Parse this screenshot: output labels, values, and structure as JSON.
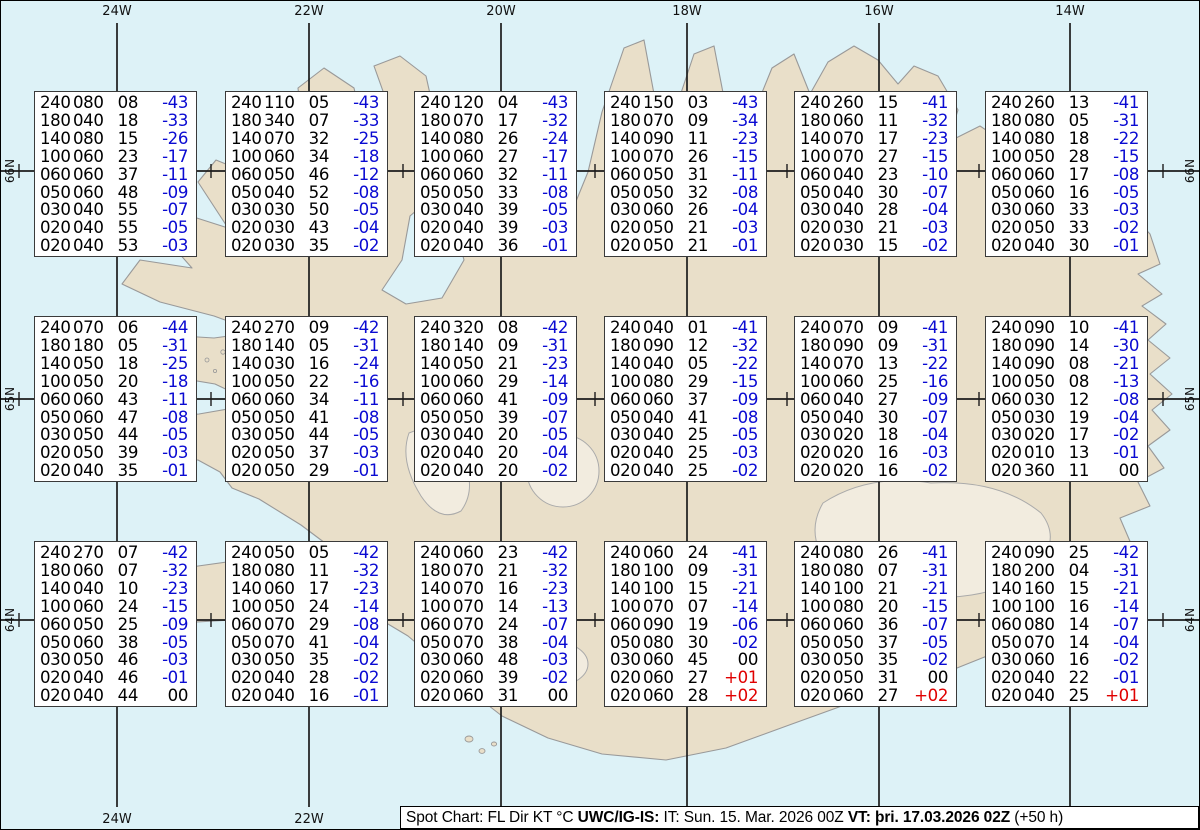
{
  "colors": {
    "ocean": "#ddf2f7",
    "land": "#e9dfc9",
    "coastline": "#999999",
    "gridline": "#1c1c1c",
    "temp_negative": "#0a0ad2",
    "temp_positive": "#e00000",
    "text": "#000000"
  },
  "grid": {
    "longitudes": [
      {
        "label": "24W",
        "x": 116
      },
      {
        "label": "22W",
        "x": 308
      },
      {
        "label": "20W",
        "x": 500
      },
      {
        "label": "18W",
        "x": 686
      },
      {
        "label": "16W",
        "x": 878
      },
      {
        "label": "14W",
        "x": 1069
      }
    ],
    "latitudes": [
      {
        "label": "66N",
        "y": 170
      },
      {
        "label": "65N",
        "y": 398
      },
      {
        "label": "64N",
        "y": 619
      }
    ],
    "minor_tick_xs": [
      18,
      210,
      402,
      594,
      786,
      978,
      1162
    ]
  },
  "caption": {
    "segments": [
      {
        "text": "Spot Chart: FL Dir KT °C ",
        "bold": false
      },
      {
        "text": "UWC/IG-IS:",
        "bold": true
      },
      {
        "text": " IT: Sun. 15. Mar. 2026 00Z ",
        "bold": false
      },
      {
        "text": "VT: þri. 17.03.2026 02Z",
        "bold": true
      },
      {
        "text": " (+50 h)",
        "bold": false
      }
    ]
  },
  "spot_box_columns": [
    "FL",
    "Dir",
    "KT",
    "°C"
  ],
  "spot_boxes": [
    {
      "x": 33,
      "y": 90,
      "levels": [
        [
          "240",
          "080",
          "08",
          "-43"
        ],
        [
          "180",
          "040",
          "18",
          "-33"
        ],
        [
          "140",
          "080",
          "15",
          "-26"
        ],
        [
          "100",
          "060",
          "23",
          "-17"
        ],
        [
          "060",
          "060",
          "37",
          "-11"
        ],
        [
          "050",
          "060",
          "48",
          "-09"
        ],
        [
          "030",
          "040",
          "55",
          "-07"
        ],
        [
          "020",
          "040",
          "55",
          "-05"
        ],
        [
          "020",
          "040",
          "53",
          "-03"
        ]
      ]
    },
    {
      "x": 224,
      "y": 90,
      "levels": [
        [
          "240",
          "110",
          "05",
          "-43"
        ],
        [
          "180",
          "340",
          "07",
          "-33"
        ],
        [
          "140",
          "070",
          "32",
          "-25"
        ],
        [
          "100",
          "060",
          "34",
          "-18"
        ],
        [
          "060",
          "050",
          "46",
          "-12"
        ],
        [
          "050",
          "040",
          "52",
          "-08"
        ],
        [
          "030",
          "030",
          "50",
          "-05"
        ],
        [
          "020",
          "030",
          "43",
          "-04"
        ],
        [
          "020",
          "030",
          "35",
          "-02"
        ]
      ]
    },
    {
      "x": 413,
      "y": 90,
      "levels": [
        [
          "240",
          "120",
          "04",
          "-43"
        ],
        [
          "180",
          "070",
          "17",
          "-32"
        ],
        [
          "140",
          "080",
          "26",
          "-24"
        ],
        [
          "100",
          "060",
          "27",
          "-17"
        ],
        [
          "060",
          "060",
          "32",
          "-11"
        ],
        [
          "050",
          "050",
          "33",
          "-08"
        ],
        [
          "030",
          "040",
          "39",
          "-05"
        ],
        [
          "020",
          "040",
          "39",
          "-03"
        ],
        [
          "020",
          "040",
          "36",
          "-01"
        ]
      ]
    },
    {
      "x": 603,
      "y": 90,
      "levels": [
        [
          "240",
          "150",
          "03",
          "-43"
        ],
        [
          "180",
          "070",
          "09",
          "-34"
        ],
        [
          "140",
          "090",
          "11",
          "-23"
        ],
        [
          "100",
          "070",
          "26",
          "-15"
        ],
        [
          "060",
          "050",
          "31",
          "-11"
        ],
        [
          "050",
          "050",
          "32",
          "-08"
        ],
        [
          "030",
          "060",
          "26",
          "-04"
        ],
        [
          "020",
          "050",
          "21",
          "-03"
        ],
        [
          "020",
          "050",
          "21",
          "-01"
        ]
      ]
    },
    {
      "x": 793,
      "y": 90,
      "levels": [
        [
          "240",
          "260",
          "15",
          "-41"
        ],
        [
          "180",
          "060",
          "11",
          "-32"
        ],
        [
          "140",
          "070",
          "17",
          "-23"
        ],
        [
          "100",
          "070",
          "27",
          "-15"
        ],
        [
          "060",
          "040",
          "23",
          "-10"
        ],
        [
          "050",
          "040",
          "30",
          "-07"
        ],
        [
          "030",
          "040",
          "28",
          "-04"
        ],
        [
          "020",
          "030",
          "21",
          "-03"
        ],
        [
          "020",
          "030",
          "15",
          "-02"
        ]
      ]
    },
    {
      "x": 984,
      "y": 90,
      "levels": [
        [
          "240",
          "260",
          "13",
          "-41"
        ],
        [
          "180",
          "080",
          "05",
          "-31"
        ],
        [
          "140",
          "080",
          "18",
          "-22"
        ],
        [
          "100",
          "050",
          "28",
          "-15"
        ],
        [
          "060",
          "060",
          "17",
          "-08"
        ],
        [
          "050",
          "060",
          "16",
          "-05"
        ],
        [
          "030",
          "060",
          "33",
          "-03"
        ],
        [
          "020",
          "050",
          "33",
          "-02"
        ],
        [
          "020",
          "040",
          "30",
          "-01"
        ]
      ]
    },
    {
      "x": 33,
      "y": 315,
      "levels": [
        [
          "240",
          "070",
          "06",
          "-44"
        ],
        [
          "180",
          "180",
          "05",
          "-31"
        ],
        [
          "140",
          "050",
          "18",
          "-25"
        ],
        [
          "100",
          "050",
          "20",
          "-18"
        ],
        [
          "060",
          "060",
          "43",
          "-11"
        ],
        [
          "050",
          "060",
          "47",
          "-08"
        ],
        [
          "030",
          "050",
          "44",
          "-05"
        ],
        [
          "020",
          "050",
          "39",
          "-03"
        ],
        [
          "020",
          "040",
          "35",
          "-01"
        ]
      ]
    },
    {
      "x": 224,
      "y": 315,
      "levels": [
        [
          "240",
          "270",
          "09",
          "-42"
        ],
        [
          "180",
          "140",
          "05",
          "-31"
        ],
        [
          "140",
          "030",
          "16",
          "-24"
        ],
        [
          "100",
          "050",
          "22",
          "-16"
        ],
        [
          "060",
          "060",
          "34",
          "-11"
        ],
        [
          "050",
          "050",
          "41",
          "-08"
        ],
        [
          "030",
          "050",
          "44",
          "-05"
        ],
        [
          "020",
          "050",
          "37",
          "-03"
        ],
        [
          "020",
          "050",
          "29",
          "-01"
        ]
      ]
    },
    {
      "x": 413,
      "y": 315,
      "levels": [
        [
          "240",
          "320",
          "08",
          "-42"
        ],
        [
          "180",
          "140",
          "09",
          "-31"
        ],
        [
          "140",
          "050",
          "21",
          "-23"
        ],
        [
          "100",
          "060",
          "29",
          "-14"
        ],
        [
          "060",
          "060",
          "41",
          "-09"
        ],
        [
          "050",
          "050",
          "39",
          "-07"
        ],
        [
          "030",
          "040",
          "20",
          "-05"
        ],
        [
          "020",
          "040",
          "20",
          "-04"
        ],
        [
          "020",
          "040",
          "20",
          "-02"
        ]
      ]
    },
    {
      "x": 603,
      "y": 315,
      "levels": [
        [
          "240",
          "040",
          "01",
          "-41"
        ],
        [
          "180",
          "090",
          "12",
          "-32"
        ],
        [
          "140",
          "040",
          "05",
          "-22"
        ],
        [
          "100",
          "080",
          "29",
          "-15"
        ],
        [
          "060",
          "060",
          "37",
          "-09"
        ],
        [
          "050",
          "040",
          "41",
          "-08"
        ],
        [
          "030",
          "040",
          "25",
          "-05"
        ],
        [
          "020",
          "040",
          "25",
          "-03"
        ],
        [
          "020",
          "040",
          "25",
          "-02"
        ]
      ]
    },
    {
      "x": 793,
      "y": 315,
      "levels": [
        [
          "240",
          "070",
          "09",
          "-41"
        ],
        [
          "180",
          "090",
          "09",
          "-31"
        ],
        [
          "140",
          "070",
          "13",
          "-22"
        ],
        [
          "100",
          "060",
          "25",
          "-16"
        ],
        [
          "060",
          "040",
          "27",
          "-09"
        ],
        [
          "050",
          "040",
          "30",
          "-07"
        ],
        [
          "030",
          "020",
          "18",
          "-04"
        ],
        [
          "020",
          "020",
          "16",
          "-03"
        ],
        [
          "020",
          "020",
          "16",
          "-02"
        ]
      ]
    },
    {
      "x": 984,
      "y": 315,
      "levels": [
        [
          "240",
          "090",
          "10",
          "-41"
        ],
        [
          "180",
          "090",
          "14",
          "-30"
        ],
        [
          "140",
          "090",
          "08",
          "-21"
        ],
        [
          "100",
          "050",
          "08",
          "-13"
        ],
        [
          "060",
          "030",
          "12",
          "-08"
        ],
        [
          "050",
          "030",
          "19",
          "-04"
        ],
        [
          "030",
          "020",
          "17",
          "-02"
        ],
        [
          "020",
          "010",
          "13",
          "-01"
        ],
        [
          "020",
          "360",
          "11",
          "00"
        ]
      ]
    },
    {
      "x": 33,
      "y": 540,
      "levels": [
        [
          "240",
          "270",
          "07",
          "-42"
        ],
        [
          "180",
          "060",
          "07",
          "-32"
        ],
        [
          "140",
          "040",
          "10",
          "-23"
        ],
        [
          "100",
          "060",
          "24",
          "-15"
        ],
        [
          "060",
          "050",
          "25",
          "-09"
        ],
        [
          "050",
          "060",
          "38",
          "-05"
        ],
        [
          "030",
          "050",
          "46",
          "-03"
        ],
        [
          "020",
          "040",
          "46",
          "-01"
        ],
        [
          "020",
          "040",
          "44",
          "00"
        ]
      ]
    },
    {
      "x": 224,
      "y": 540,
      "levels": [
        [
          "240",
          "050",
          "05",
          "-42"
        ],
        [
          "180",
          "080",
          "11",
          "-32"
        ],
        [
          "140",
          "060",
          "17",
          "-23"
        ],
        [
          "100",
          "050",
          "24",
          "-14"
        ],
        [
          "060",
          "070",
          "29",
          "-08"
        ],
        [
          "050",
          "070",
          "41",
          "-04"
        ],
        [
          "030",
          "050",
          "35",
          "-02"
        ],
        [
          "020",
          "040",
          "28",
          "-02"
        ],
        [
          "020",
          "040",
          "16",
          "-01"
        ]
      ]
    },
    {
      "x": 413,
      "y": 540,
      "levels": [
        [
          "240",
          "060",
          "23",
          "-42"
        ],
        [
          "180",
          "070",
          "21",
          "-32"
        ],
        [
          "140",
          "070",
          "16",
          "-23"
        ],
        [
          "100",
          "070",
          "14",
          "-13"
        ],
        [
          "060",
          "070",
          "24",
          "-07"
        ],
        [
          "050",
          "070",
          "38",
          "-04"
        ],
        [
          "030",
          "060",
          "48",
          "-03"
        ],
        [
          "020",
          "060",
          "39",
          "-02"
        ],
        [
          "020",
          "060",
          "31",
          "00"
        ]
      ]
    },
    {
      "x": 603,
      "y": 540,
      "levels": [
        [
          "240",
          "060",
          "24",
          "-41"
        ],
        [
          "180",
          "100",
          "09",
          "-31"
        ],
        [
          "140",
          "100",
          "15",
          "-21"
        ],
        [
          "100",
          "070",
          "07",
          "-14"
        ],
        [
          "060",
          "090",
          "19",
          "-06"
        ],
        [
          "050",
          "080",
          "30",
          "-02"
        ],
        [
          "030",
          "060",
          "45",
          "00"
        ],
        [
          "020",
          "060",
          "27",
          "+01"
        ],
        [
          "020",
          "060",
          "28",
          "+02"
        ]
      ]
    },
    {
      "x": 793,
      "y": 540,
      "levels": [
        [
          "240",
          "080",
          "26",
          "-41"
        ],
        [
          "180",
          "080",
          "07",
          "-31"
        ],
        [
          "140",
          "100",
          "21",
          "-21"
        ],
        [
          "100",
          "080",
          "20",
          "-15"
        ],
        [
          "060",
          "060",
          "36",
          "-07"
        ],
        [
          "050",
          "050",
          "37",
          "-05"
        ],
        [
          "030",
          "050",
          "35",
          "-02"
        ],
        [
          "020",
          "050",
          "31",
          "00"
        ],
        [
          "020",
          "060",
          "27",
          "+02"
        ]
      ]
    },
    {
      "x": 984,
      "y": 540,
      "levels": [
        [
          "240",
          "090",
          "25",
          "-42"
        ],
        [
          "180",
          "200",
          "04",
          "-31"
        ],
        [
          "140",
          "160",
          "15",
          "-21"
        ],
        [
          "100",
          "100",
          "16",
          "-14"
        ],
        [
          "060",
          "080",
          "14",
          "-07"
        ],
        [
          "050",
          "070",
          "14",
          "-04"
        ],
        [
          "030",
          "060",
          "16",
          "-02"
        ],
        [
          "020",
          "040",
          "22",
          "-01"
        ],
        [
          "020",
          "040",
          "25",
          "+01"
        ]
      ]
    }
  ]
}
